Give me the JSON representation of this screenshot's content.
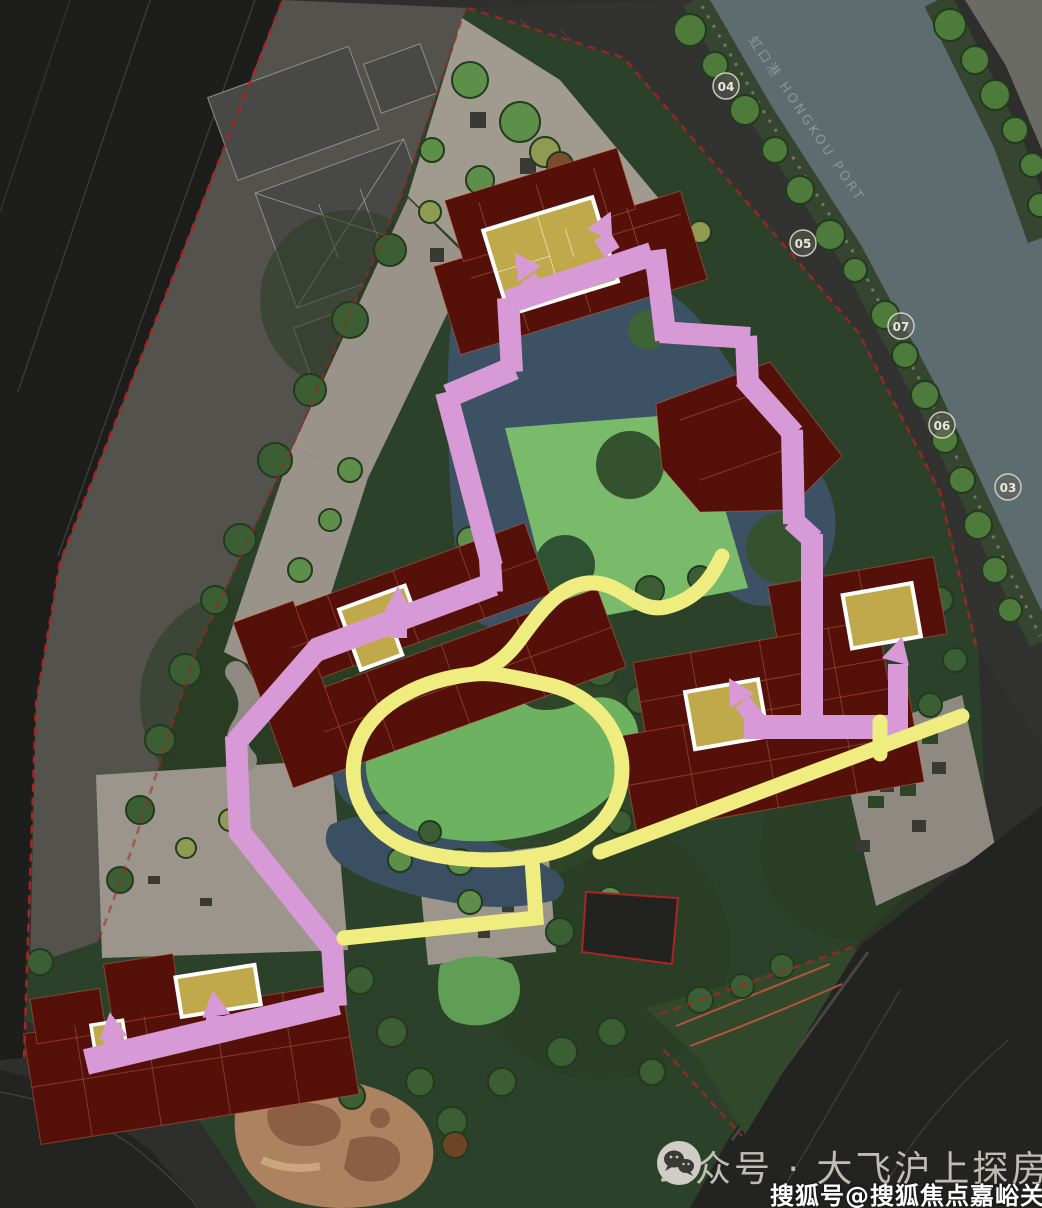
{
  "site_plan": {
    "river_label": "虹口港 HONGKOU PORT",
    "road_markers": [
      {
        "label": "04"
      },
      {
        "label": "05"
      },
      {
        "label": "07"
      },
      {
        "label": "06"
      },
      {
        "label": "03"
      }
    ],
    "colors": {
      "route_pink": "#d79ad7",
      "route_yellow": "#efec80",
      "building_red": "#551109",
      "highlight_unit_yellow": "#c0a94b",
      "lawn_green": "#76b868",
      "pond_blue": "#3c5163",
      "river_teal": "#5c6c6e",
      "boundary_red": "#a82522",
      "plaza_gray": "#a09a8f"
    }
  },
  "watermarks": {
    "wechat_text": "公众号 · 大飞沪上探房",
    "sohu_text": "搜狐号@搜狐焦点嘉峪关站"
  }
}
